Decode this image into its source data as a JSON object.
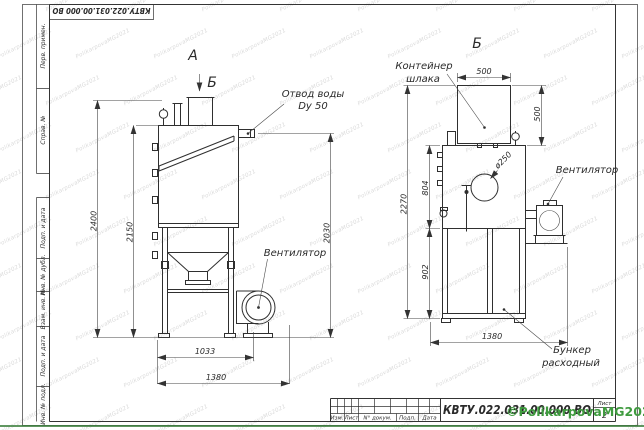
{
  "frame": {
    "top_stamp": "КВТУ.022.031.00.000 ВО",
    "left_top_cells": [
      "Перв. примен.",
      "Справ. №"
    ],
    "left_bottom_cells": [
      "Подп. и дата",
      "Инв. № дубл.",
      "Взам. инв. №",
      "Подп. и дата",
      "Инв. № подл."
    ]
  },
  "title_block": {
    "doc_number": "КВТУ.022.031.00.000 ВО",
    "bottom_labels": [
      "Изм.",
      "Лист",
      "N° докум.",
      "Подп.",
      "Дата"
    ]
  },
  "sheet": {
    "label": "Лист",
    "number": "2"
  },
  "views": {
    "a_label": "А",
    "b_marker": "Б",
    "b_label": "Б"
  },
  "labels": {
    "water_outlet_1": "Отвод воды",
    "water_outlet_2": "Dy 50",
    "fan": "Вентилятор",
    "container_1": "Контейнер",
    "container_2": "шлака",
    "hopper_1": "Бункер",
    "hopper_2": "расходный",
    "diameter": "ø250"
  },
  "dims": {
    "left": [
      "2400",
      "2150",
      "2030",
      "1033",
      "1380"
    ],
    "right": [
      "500",
      "500",
      "2270",
      "804",
      "902",
      "1380"
    ]
  },
  "watermark": {
    "tile": "PolikarpovaMG2021",
    "stamp": "©PolikarpovaMG2021",
    "color": "#3f9b3f",
    "line_color": "rgba(56,125,58,0.8)"
  }
}
